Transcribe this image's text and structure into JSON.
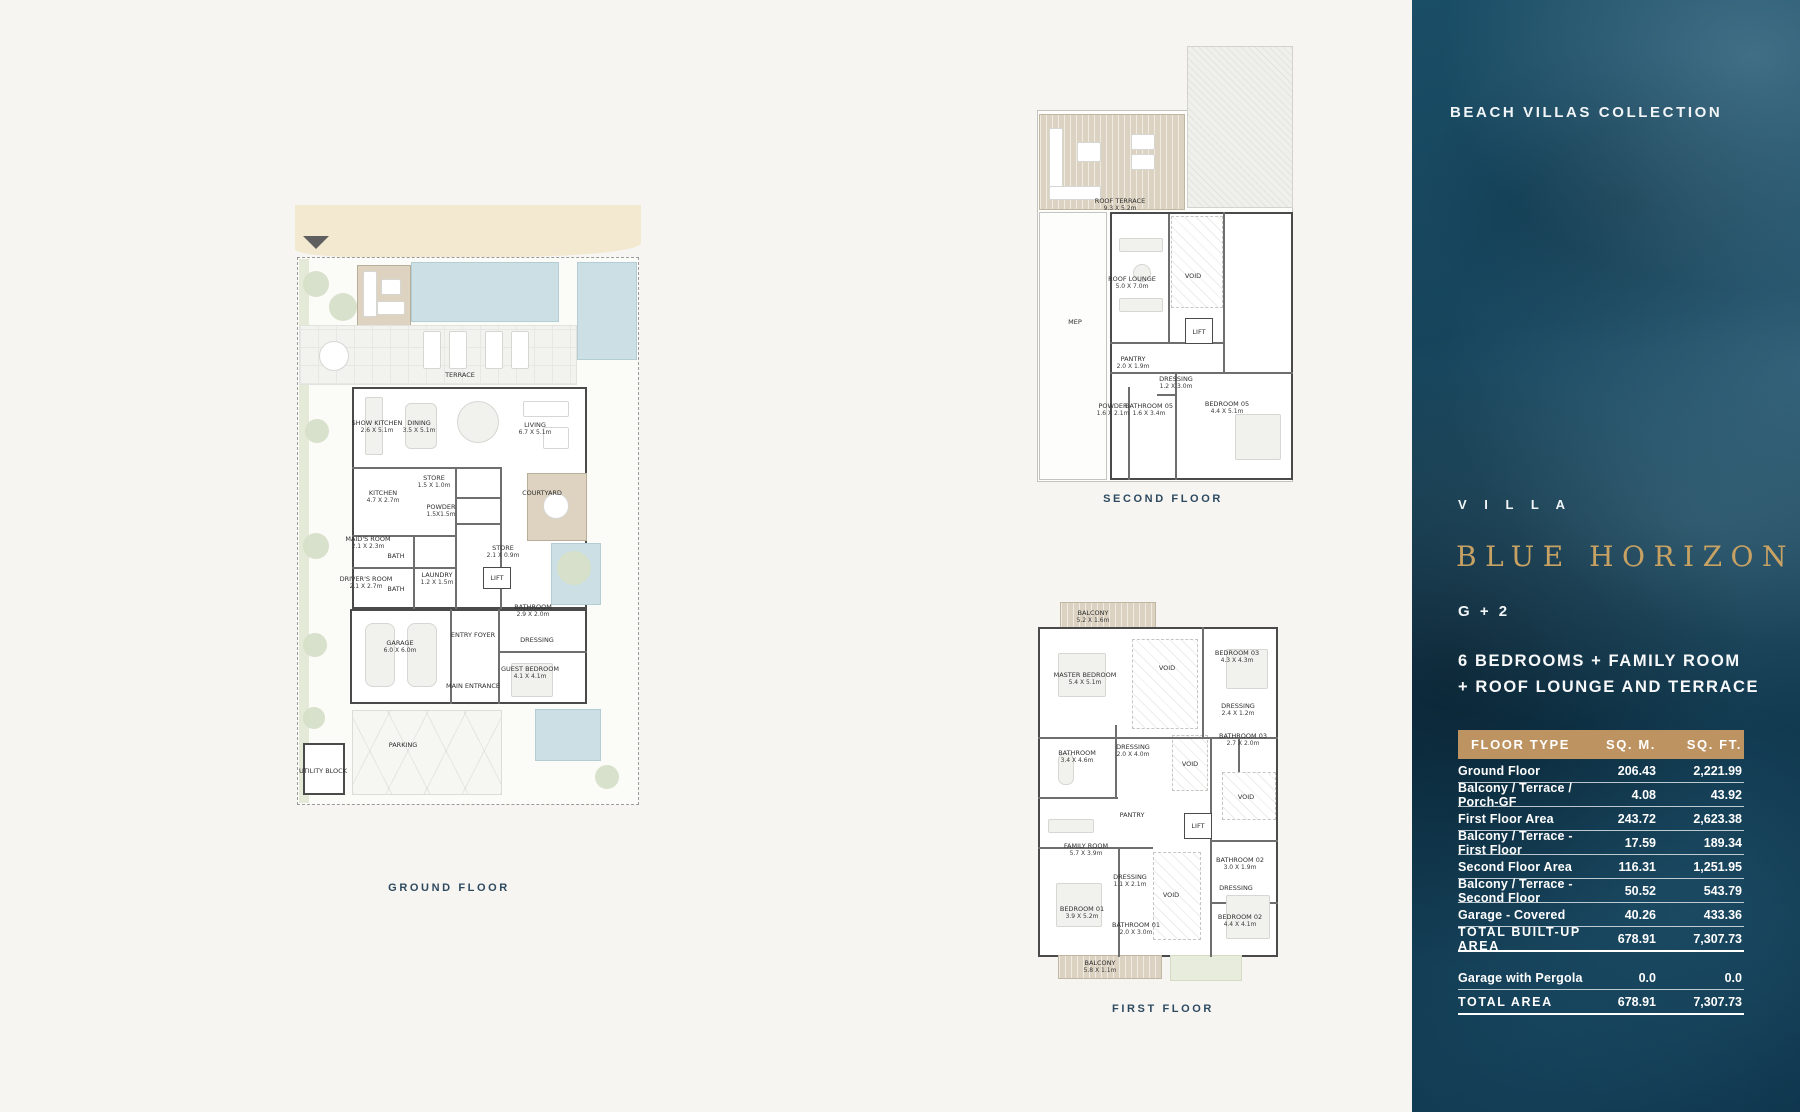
{
  "sidebar": {
    "collection": "BEACH VILLAS COLLECTION",
    "villa_label": "V I L L A",
    "villa_name": "BLUE HORIZON",
    "storeys": "G + 2",
    "description_line1": "6 BEDROOMS + FAMILY ROOM",
    "description_line2": "+ ROOF LOUNGE AND TERRACE",
    "colors": {
      "background": "#123c52",
      "gold_text": "#c8a263",
      "table_header_bg": "#bd9361"
    },
    "table": {
      "headers": [
        "FLOOR TYPE",
        "SQ. M.",
        "SQ. FT."
      ],
      "rows": [
        {
          "label": "Ground Floor",
          "sqm": "206.43",
          "sqft": "2,221.99",
          "emphasis": false,
          "gap_before": false
        },
        {
          "label": "Balcony / Terrace / Porch-GF",
          "sqm": "4.08",
          "sqft": "43.92",
          "emphasis": false,
          "gap_before": false
        },
        {
          "label": "First Floor Area",
          "sqm": "243.72",
          "sqft": "2,623.38",
          "emphasis": false,
          "gap_before": false
        },
        {
          "label": "Balcony / Terrace - First Floor",
          "sqm": "17.59",
          "sqft": "189.34",
          "emphasis": false,
          "gap_before": false
        },
        {
          "label": "Second Floor Area",
          "sqm": "116.31",
          "sqft": "1,251.95",
          "emphasis": false,
          "gap_before": false
        },
        {
          "label": "Balcony / Terrace - Second Floor",
          "sqm": "50.52",
          "sqft": "543.79",
          "emphasis": false,
          "gap_before": false
        },
        {
          "label": "Garage - Covered",
          "sqm": "40.26",
          "sqft": "433.36",
          "emphasis": false,
          "gap_before": false
        },
        {
          "label": "TOTAL BUILT-UP AREA",
          "sqm": "678.91",
          "sqft": "7,307.73",
          "emphasis": true,
          "gap_before": false
        },
        {
          "label": "Garage with Pergola",
          "sqm": "0.0",
          "sqft": "0.0",
          "emphasis": false,
          "gap_before": true
        },
        {
          "label": "TOTAL AREA",
          "sqm": "678.91",
          "sqft": "7,307.73",
          "emphasis": true,
          "gap_before": false
        }
      ]
    }
  },
  "plans": {
    "ground": {
      "caption": "GROUND FLOOR",
      "rooms": [
        {
          "name": "TERRACE",
          "dims": ""
        },
        {
          "name": "SHOW KITCHEN",
          "dims": "2.6 X 5.1m"
        },
        {
          "name": "DINING",
          "dims": "3.5 X 5.1m"
        },
        {
          "name": "LIVING",
          "dims": "6.7 X 5.1m"
        },
        {
          "name": "KITCHEN",
          "dims": "4.7 X 2.7m"
        },
        {
          "name": "STORE",
          "dims": "1.5 X 1.0m"
        },
        {
          "name": "POWDER",
          "dims": "1.5X1.5m"
        },
        {
          "name": "COURTYARD",
          "dims": ""
        },
        {
          "name": "MAID'S ROOM",
          "dims": "2.1 X 2.3m"
        },
        {
          "name": "BATH",
          "dims": ""
        },
        {
          "name": "DRIVER'S ROOM",
          "dims": "2.1 X 2.7m"
        },
        {
          "name": "BATH",
          "dims": ""
        },
        {
          "name": "LAUNDRY",
          "dims": "1.2 X 1.5m"
        },
        {
          "name": "STORE",
          "dims": "2.1 X 0.9m"
        },
        {
          "name": "LIFT",
          "dims": ""
        },
        {
          "name": "BATHROOM",
          "dims": "2.9 X 2.0m"
        },
        {
          "name": "DRESSING",
          "dims": ""
        },
        {
          "name": "GUEST BEDROOM",
          "dims": "4.1 X 4.1m"
        },
        {
          "name": "GARAGE",
          "dims": "6.0 X 6.0m"
        },
        {
          "name": "ENTRY FOYER",
          "dims": ""
        },
        {
          "name": "MAIN ENTRANCE",
          "dims": ""
        },
        {
          "name": "PARKING",
          "dims": ""
        },
        {
          "name": "UTILITY BLOCK",
          "dims": ""
        }
      ]
    },
    "second": {
      "caption": "SECOND FLOOR",
      "rooms": [
        {
          "name": "ROOF TERRACE",
          "dims": "9.3 X 5.2m"
        },
        {
          "name": "ROOF LOUNGE",
          "dims": "5.0 X 7.0m"
        },
        {
          "name": "MEP",
          "dims": ""
        },
        {
          "name": "VOID",
          "dims": ""
        },
        {
          "name": "LIFT",
          "dims": ""
        },
        {
          "name": "PANTRY",
          "dims": "2.0 X 1.9m"
        },
        {
          "name": "DRESSING",
          "dims": "1.2 X 3.0m"
        },
        {
          "name": "BATHROOM 05",
          "dims": "1.6 X 3.4m"
        },
        {
          "name": "POWDER",
          "dims": "1.6 X 2.1m"
        },
        {
          "name": "BEDROOM 05",
          "dims": "4.4 X 5.1m"
        }
      ]
    },
    "first": {
      "caption": "FIRST FLOOR",
      "rooms": [
        {
          "name": "BALCONY",
          "dims": "5.2 X 1.6m"
        },
        {
          "name": "MASTER BEDROOM",
          "dims": "5.4 X 5.1m"
        },
        {
          "name": "VOID",
          "dims": ""
        },
        {
          "name": "BEDROOM 03",
          "dims": "4.3 X 4.3m"
        },
        {
          "name": "DRESSING",
          "dims": "2.4 X 1.2m"
        },
        {
          "name": "BATHROOM 03",
          "dims": "2.7 X 2.0m"
        },
        {
          "name": "BATHROOM",
          "dims": "3.4 X 4.6m"
        },
        {
          "name": "DRESSING",
          "dims": "2.0 X 4.0m"
        },
        {
          "name": "VOID",
          "dims": ""
        },
        {
          "name": "PANTRY",
          "dims": ""
        },
        {
          "name": "FAMILY ROOM",
          "dims": "5.7 X 3.9m"
        },
        {
          "name": "LIFT",
          "dims": ""
        },
        {
          "name": "VOID",
          "dims": ""
        },
        {
          "name": "BATHROOM 02",
          "dims": "3.0 X 1.9m"
        },
        {
          "name": "DRESSING",
          "dims": ""
        },
        {
          "name": "BEDROOM 02",
          "dims": "4.4 X 4.1m"
        },
        {
          "name": "DRESSING",
          "dims": "1.1 X 2.1m"
        },
        {
          "name": "BEDROOM 01",
          "dims": "3.9 X 5.2m"
        },
        {
          "name": "BATHROOM 01",
          "dims": "2.0 X 3.0m"
        },
        {
          "name": "VOID",
          "dims": ""
        },
        {
          "name": "BALCONY",
          "dims": "5.8 X 1.1m"
        }
      ]
    }
  }
}
